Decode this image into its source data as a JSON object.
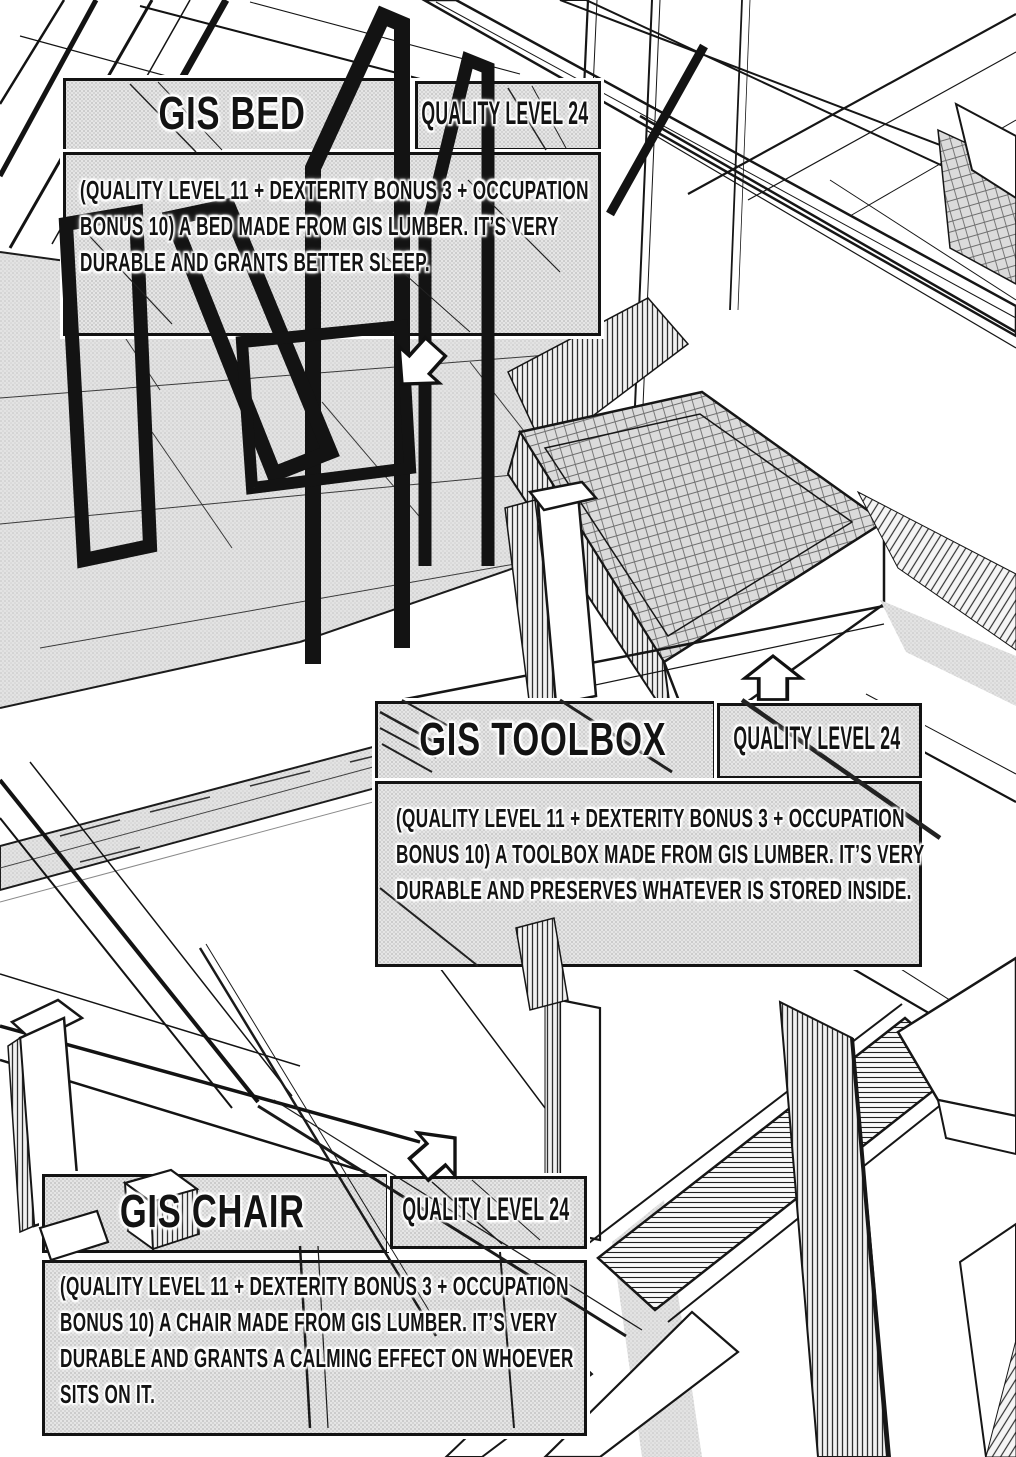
{
  "panels": [
    {
      "item": "bed",
      "title": "GIS BED",
      "quality_label": "QUALITY LEVEL 24",
      "description_lines": [
        "(QUALITY LEVEL 11 + DEXTERITY BONUS 3 + OCCUPATION",
        "BONUS 10) A BED MADE FROM GIS LUMBER. IT’S VERY",
        "DURABLE AND GRANTS BETTER SLEEP."
      ]
    },
    {
      "item": "toolbox",
      "title": "GIS TOOLBOX",
      "quality_label": "QUALITY LEVEL 24",
      "description_lines": [
        "(QUALITY LEVEL 11 + DEXTERITY BONUS 3 + OCCUPATION",
        "BONUS 10) A TOOLBOX MADE FROM GIS LUMBER. IT’S VERY",
        "DURABLE AND PRESERVES WHATEVER IS STORED INSIDE."
      ]
    },
    {
      "item": "chair",
      "title": "GIS CHAIR",
      "quality_label": "QUALITY LEVEL 24",
      "description_lines": [
        "(QUALITY LEVEL 11 + DEXTERITY BONUS 3 + OCCUPATION",
        "BONUS 10) A CHAIR MADE FROM GIS LUMBER. IT’S VERY",
        "DURABLE AND GRANTS A CALMING EFFECT ON WHOEVER",
        "SITS ON IT."
      ]
    }
  ],
  "pointers": [
    {
      "target": "bed",
      "icon": "arrow-down-left-icon"
    },
    {
      "target": "toolbox",
      "icon": "arrow-up-icon"
    },
    {
      "target": "chair",
      "icon": "arrow-up-right-icon"
    }
  ],
  "colors": {
    "ink": "#131313",
    "paper": "#ffffff",
    "panel_tone": "#e5e5e5",
    "halftone_dot": "#c3c3c3"
  }
}
